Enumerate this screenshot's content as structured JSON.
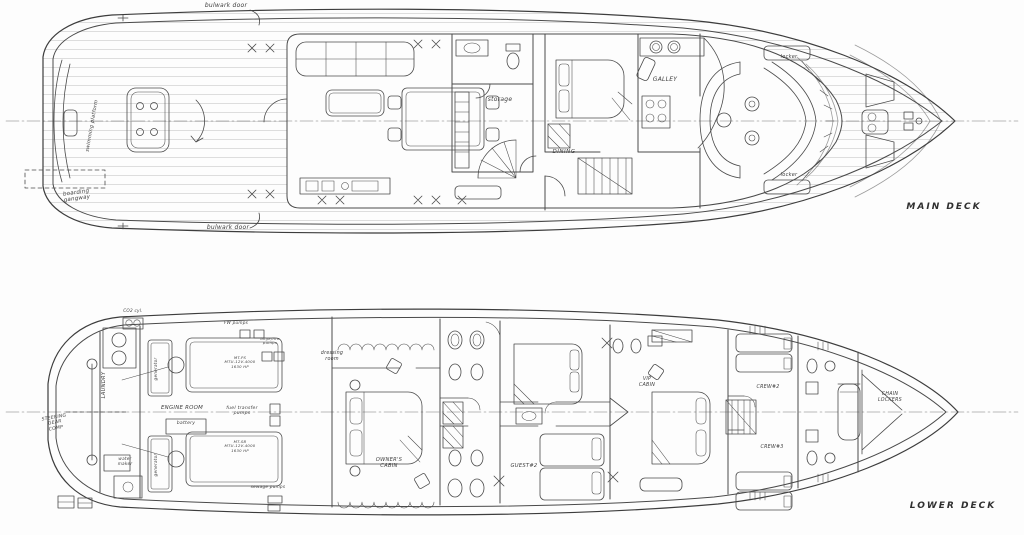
{
  "page": {
    "background": "#fdfdfd",
    "ink": "#4a4a4a"
  },
  "main_deck": {
    "title": "MAIN DECK",
    "labels": {
      "bulwark_door_top": "bulwark door",
      "bulwark_door_bottom": "bulwark door",
      "boarding_gangway": "boarding\ngangway",
      "swim_platform": "swimming platform",
      "storage": "storage",
      "dining": "DINING",
      "galley": "GALLEY",
      "locker_fwd_top": "locker",
      "locker_fwd_bottom": "locker"
    }
  },
  "lower_deck": {
    "title": "LOWER DECK",
    "labels": {
      "steering_gear": "STEERING\nGEAR\nCOMP",
      "laundry": "LAUNDRY",
      "co2": "CO2 cyl.",
      "generator_port": "generator",
      "generator_stbd": "generator",
      "engine_room": "ENGINE ROOM",
      "battery": "battery",
      "fw_pumps": "FW pumps",
      "bilge_fire_pumps": "bilge/fire\npumps",
      "fuel_transfer_pumps": "fuel transfer\npumps",
      "engine_port": "MT-PS\nMTU-12V-4000\n1630 HP",
      "engine_stbd": "MT-SB\nMTU-12V-4000\n1630 HP",
      "sewage_pumps": "sewage pumps",
      "water_maker": "water\nmaker",
      "dressing_room": "dressing\nroom",
      "owners_cabin": "OWNER'S\nCABIN",
      "guest2": "GUEST#2",
      "vip_cabin": "VIP\nCABIN",
      "crew2": "CREW#2",
      "crew3": "CREW#3",
      "chain_lockers": "CHAIN\nLOCKERS"
    }
  }
}
